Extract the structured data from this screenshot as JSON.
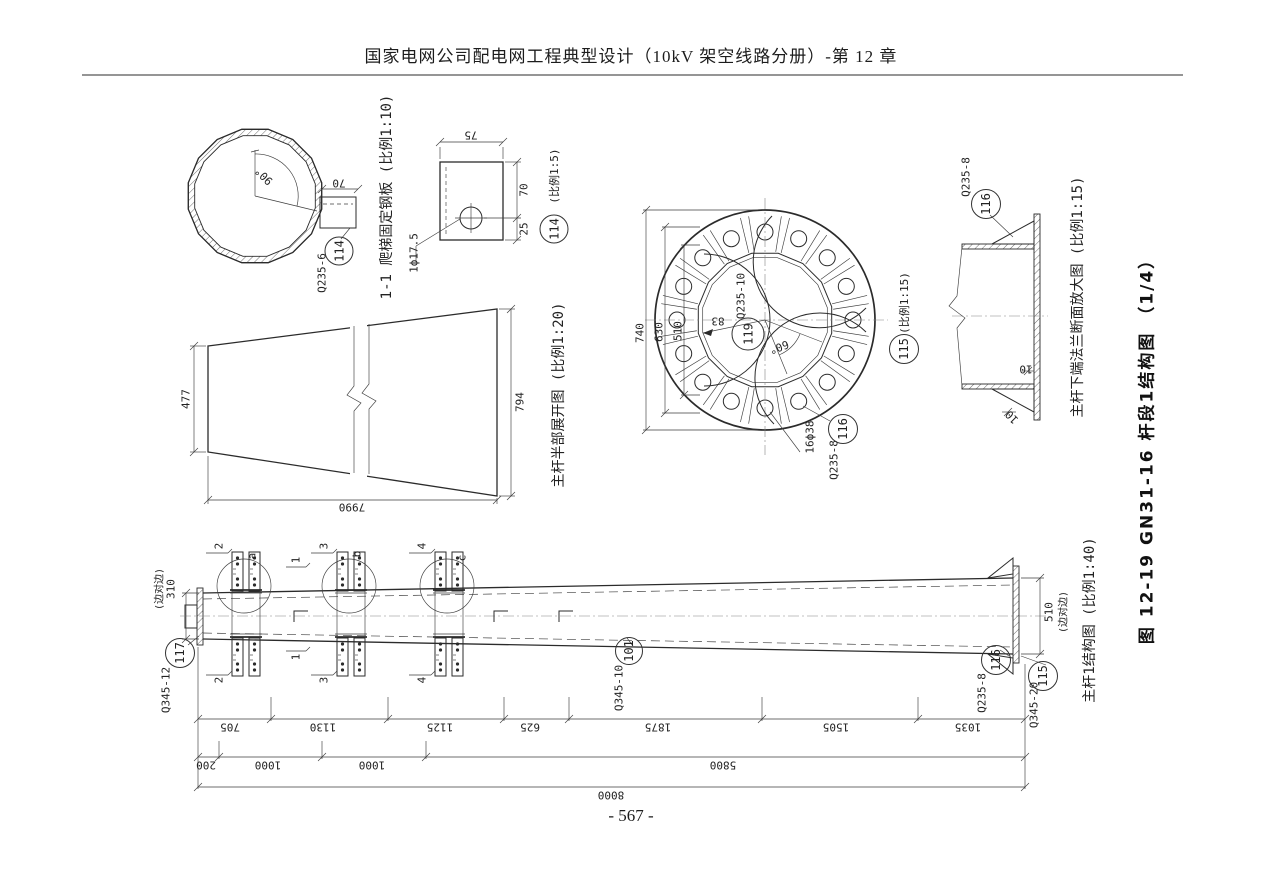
{
  "page": {
    "header": "国家电网公司配电网工程典型设计（10kV 架空线路分册）-第 12 章",
    "footer": "- 567 -",
    "figure_title": "图 12-19  GN31-16 杆段1结构图 （1/4）"
  },
  "colors": {
    "ink": "#2b2b2b",
    "paper": "#ffffff"
  },
  "labels": [
    {
      "n": "dim-angle-90",
      "t": "90°",
      "x": 264,
      "y": 176,
      "r": -135
    },
    {
      "n": "dim-tab-70",
      "t": "70",
      "x": 339,
      "y": 183,
      "r": 180
    },
    {
      "n": "mat-q235-6",
      "t": "Q235-6",
      "x": 322,
      "y": 273,
      "r": -90
    },
    {
      "n": "view-title-ladder-plate",
      "t": "1-1 爬梯固定钢板 (比例1:10)",
      "x": 386,
      "y": 197,
      "r": -90,
      "s": 14
    },
    {
      "n": "dim-75",
      "t": "75",
      "x": 471,
      "y": 135,
      "r": 180
    },
    {
      "n": "dim-70",
      "t": "70",
      "x": 524,
      "y": 190,
      "r": -90
    },
    {
      "n": "dim-25",
      "t": "25",
      "x": 524,
      "y": 229,
      "r": -90
    },
    {
      "n": "hole-1d17-5",
      "t": "1ϕ17.5",
      "x": 414,
      "y": 253,
      "r": -90
    },
    {
      "n": "scale-1-5",
      "t": "(比例1:5)",
      "x": 554,
      "y": 176,
      "r": -90
    },
    {
      "n": "dim-740",
      "t": "740",
      "x": 640,
      "y": 333,
      "r": -90
    },
    {
      "n": "dim-630",
      "t": "630",
      "x": 659,
      "y": 332,
      "r": -90
    },
    {
      "n": "dim-510-flange",
      "t": "510",
      "x": 678,
      "y": 331,
      "r": -90
    },
    {
      "n": "dim-83",
      "t": "83",
      "x": 718,
      "y": 321,
      "r": 180
    },
    {
      "n": "mat-q235-10",
      "t": "Q235-10",
      "x": 741,
      "y": 296,
      "r": -90
    },
    {
      "n": "dim-angle-60",
      "t": "60°",
      "x": 779,
      "y": 347,
      "r": 160
    },
    {
      "n": "holes-16d38",
      "t": "16ϕ38",
      "x": 810,
      "y": 437,
      "r": -90
    },
    {
      "n": "mat-q235-8-flange",
      "t": "Q235-8",
      "x": 834,
      "y": 460,
      "r": -90
    },
    {
      "n": "scale-1-15-flange",
      "t": "(比例1:15)",
      "x": 904,
      "y": 303,
      "r": -90
    },
    {
      "n": "mat-q235-8-gusset",
      "t": "Q235-8",
      "x": 966,
      "y": 177,
      "r": -90
    },
    {
      "n": "dim-10-plate",
      "t": "10",
      "x": 1026,
      "y": 369,
      "r": 180
    },
    {
      "n": "dim-10-gusset",
      "t": "10",
      "x": 1012,
      "y": 417,
      "r": -135
    },
    {
      "n": "view-title-flange-detail",
      "t": "主杆下端法兰断面放大图 (比例1:15)",
      "x": 1077,
      "y": 297,
      "r": -90,
      "s": 14
    },
    {
      "n": "dim-477",
      "t": "477",
      "x": 186,
      "y": 399,
      "r": -90
    },
    {
      "n": "dim-794",
      "t": "794",
      "x": 520,
      "y": 402,
      "r": -90
    },
    {
      "n": "dim-7990",
      "t": "7990",
      "x": 352,
      "y": 507,
      "r": 180
    },
    {
      "n": "view-title-development",
      "t": "主杆半部展开图 (比例1:20)",
      "x": 558,
      "y": 395,
      "r": -90,
      "s": 14
    },
    {
      "n": "note-side-left",
      "t": "(边对边)",
      "x": 158,
      "y": 589,
      "r": -90,
      "s": 10
    },
    {
      "n": "dim-310",
      "t": "310",
      "x": 171,
      "y": 589,
      "r": -90
    },
    {
      "n": "mat-q345-12",
      "t": "Q345-12",
      "x": 166,
      "y": 690,
      "r": -90
    },
    {
      "n": "sec-2-top",
      "t": "2",
      "x": 219,
      "y": 546,
      "r": -90
    },
    {
      "n": "sec-2-bot",
      "t": "2",
      "x": 219,
      "y": 680,
      "r": -90
    },
    {
      "n": "sec-3-top",
      "t": "3",
      "x": 324,
      "y": 546,
      "r": -90
    },
    {
      "n": "sec-3-bot",
      "t": "3",
      "x": 324,
      "y": 680,
      "r": -90
    },
    {
      "n": "sec-4-top",
      "t": "4",
      "x": 422,
      "y": 546,
      "r": -90
    },
    {
      "n": "sec-4-bot",
      "t": "4",
      "x": 422,
      "y": 680,
      "r": -90
    },
    {
      "n": "sec-1-top",
      "t": "1",
      "x": 296,
      "y": 560,
      "r": -90
    },
    {
      "n": "sec-1-bot",
      "t": "1",
      "x": 296,
      "y": 657,
      "r": -90
    },
    {
      "n": "lbl-a",
      "t": "a",
      "x": 252,
      "y": 556,
      "r": -90
    },
    {
      "n": "lbl-b",
      "t": "b",
      "x": 357,
      "y": 554,
      "r": -90
    },
    {
      "n": "lbl-c",
      "t": "c",
      "x": 462,
      "y": 558,
      "r": -90
    },
    {
      "n": "mat-q345-10",
      "t": "Q345-10",
      "x": 619,
      "y": 688,
      "r": -90
    },
    {
      "n": "mat-q235-8-pole",
      "t": "Q235-8",
      "x": 982,
      "y": 693,
      "r": -90
    },
    {
      "n": "mat-q345-20",
      "t": "Q345-20",
      "x": 1034,
      "y": 705,
      "r": -90
    },
    {
      "n": "dim-510-pole",
      "t": "510",
      "x": 1049,
      "y": 612,
      "r": -90
    },
    {
      "n": "note-side-right",
      "t": "(边对边)",
      "x": 1062,
      "y": 612,
      "r": -90,
      "s": 10
    },
    {
      "n": "view-title-pole",
      "t": "主杆1结构图 (比例1:40)",
      "x": 1089,
      "y": 620,
      "r": -90,
      "s": 14
    },
    {
      "n": "dim-705",
      "t": "705",
      "x": 230,
      "y": 727,
      "r": 180
    },
    {
      "n": "dim-1130",
      "t": "1130",
      "x": 323,
      "y": 727,
      "r": 180
    },
    {
      "n": "dim-1125",
      "t": "1125",
      "x": 440,
      "y": 727,
      "r": 180
    },
    {
      "n": "dim-625",
      "t": "625",
      "x": 530,
      "y": 727,
      "r": 180
    },
    {
      "n": "dim-1875",
      "t": "1875",
      "x": 658,
      "y": 727,
      "r": 180
    },
    {
      "n": "dim-1505",
      "t": "1505",
      "x": 836,
      "y": 727,
      "r": 180
    },
    {
      "n": "dim-1035",
      "t": "1035",
      "x": 968,
      "y": 727,
      "r": 180
    },
    {
      "n": "dim-200",
      "t": "200",
      "x": 206,
      "y": 765,
      "r": 180
    },
    {
      "n": "dim-1000-a",
      "t": "1000",
      "x": 268,
      "y": 765,
      "r": 180
    },
    {
      "n": "dim-1000-b",
      "t": "1000",
      "x": 372,
      "y": 765,
      "r": 180
    },
    {
      "n": "dim-5800",
      "t": "5800",
      "x": 723,
      "y": 765,
      "r": 180
    },
    {
      "n": "dim-8000",
      "t": "8000",
      "x": 611,
      "y": 795,
      "r": 180
    }
  ],
  "callouts": [
    {
      "n": "callout-114-ladder",
      "t": "114",
      "x": 339,
      "y": 251,
      "d": 27
    },
    {
      "n": "callout-114-detail",
      "t": "114",
      "x": 554,
      "y": 229,
      "d": 27
    },
    {
      "n": "callout-119",
      "t": "119",
      "x": 748,
      "y": 334,
      "d": 31
    },
    {
      "n": "callout-116-flange",
      "t": "116",
      "x": 843,
      "y": 429,
      "d": 28
    },
    {
      "n": "callout-115-flange",
      "t": "115",
      "x": 904,
      "y": 349,
      "d": 28
    },
    {
      "n": "callout-116-gusset",
      "t": "116",
      "x": 986,
      "y": 204,
      "d": 28
    },
    {
      "n": "callout-117",
      "t": "117",
      "x": 180,
      "y": 653,
      "d": 28
    },
    {
      "n": "callout-101",
      "t": "101",
      "x": 629,
      "y": 651,
      "d": 26
    },
    {
      "n": "callout-116-pole",
      "t": "116",
      "x": 996,
      "y": 660,
      "d": 28
    },
    {
      "n": "callout-115-pole",
      "t": "115",
      "x": 1043,
      "y": 676,
      "d": 28
    }
  ]
}
